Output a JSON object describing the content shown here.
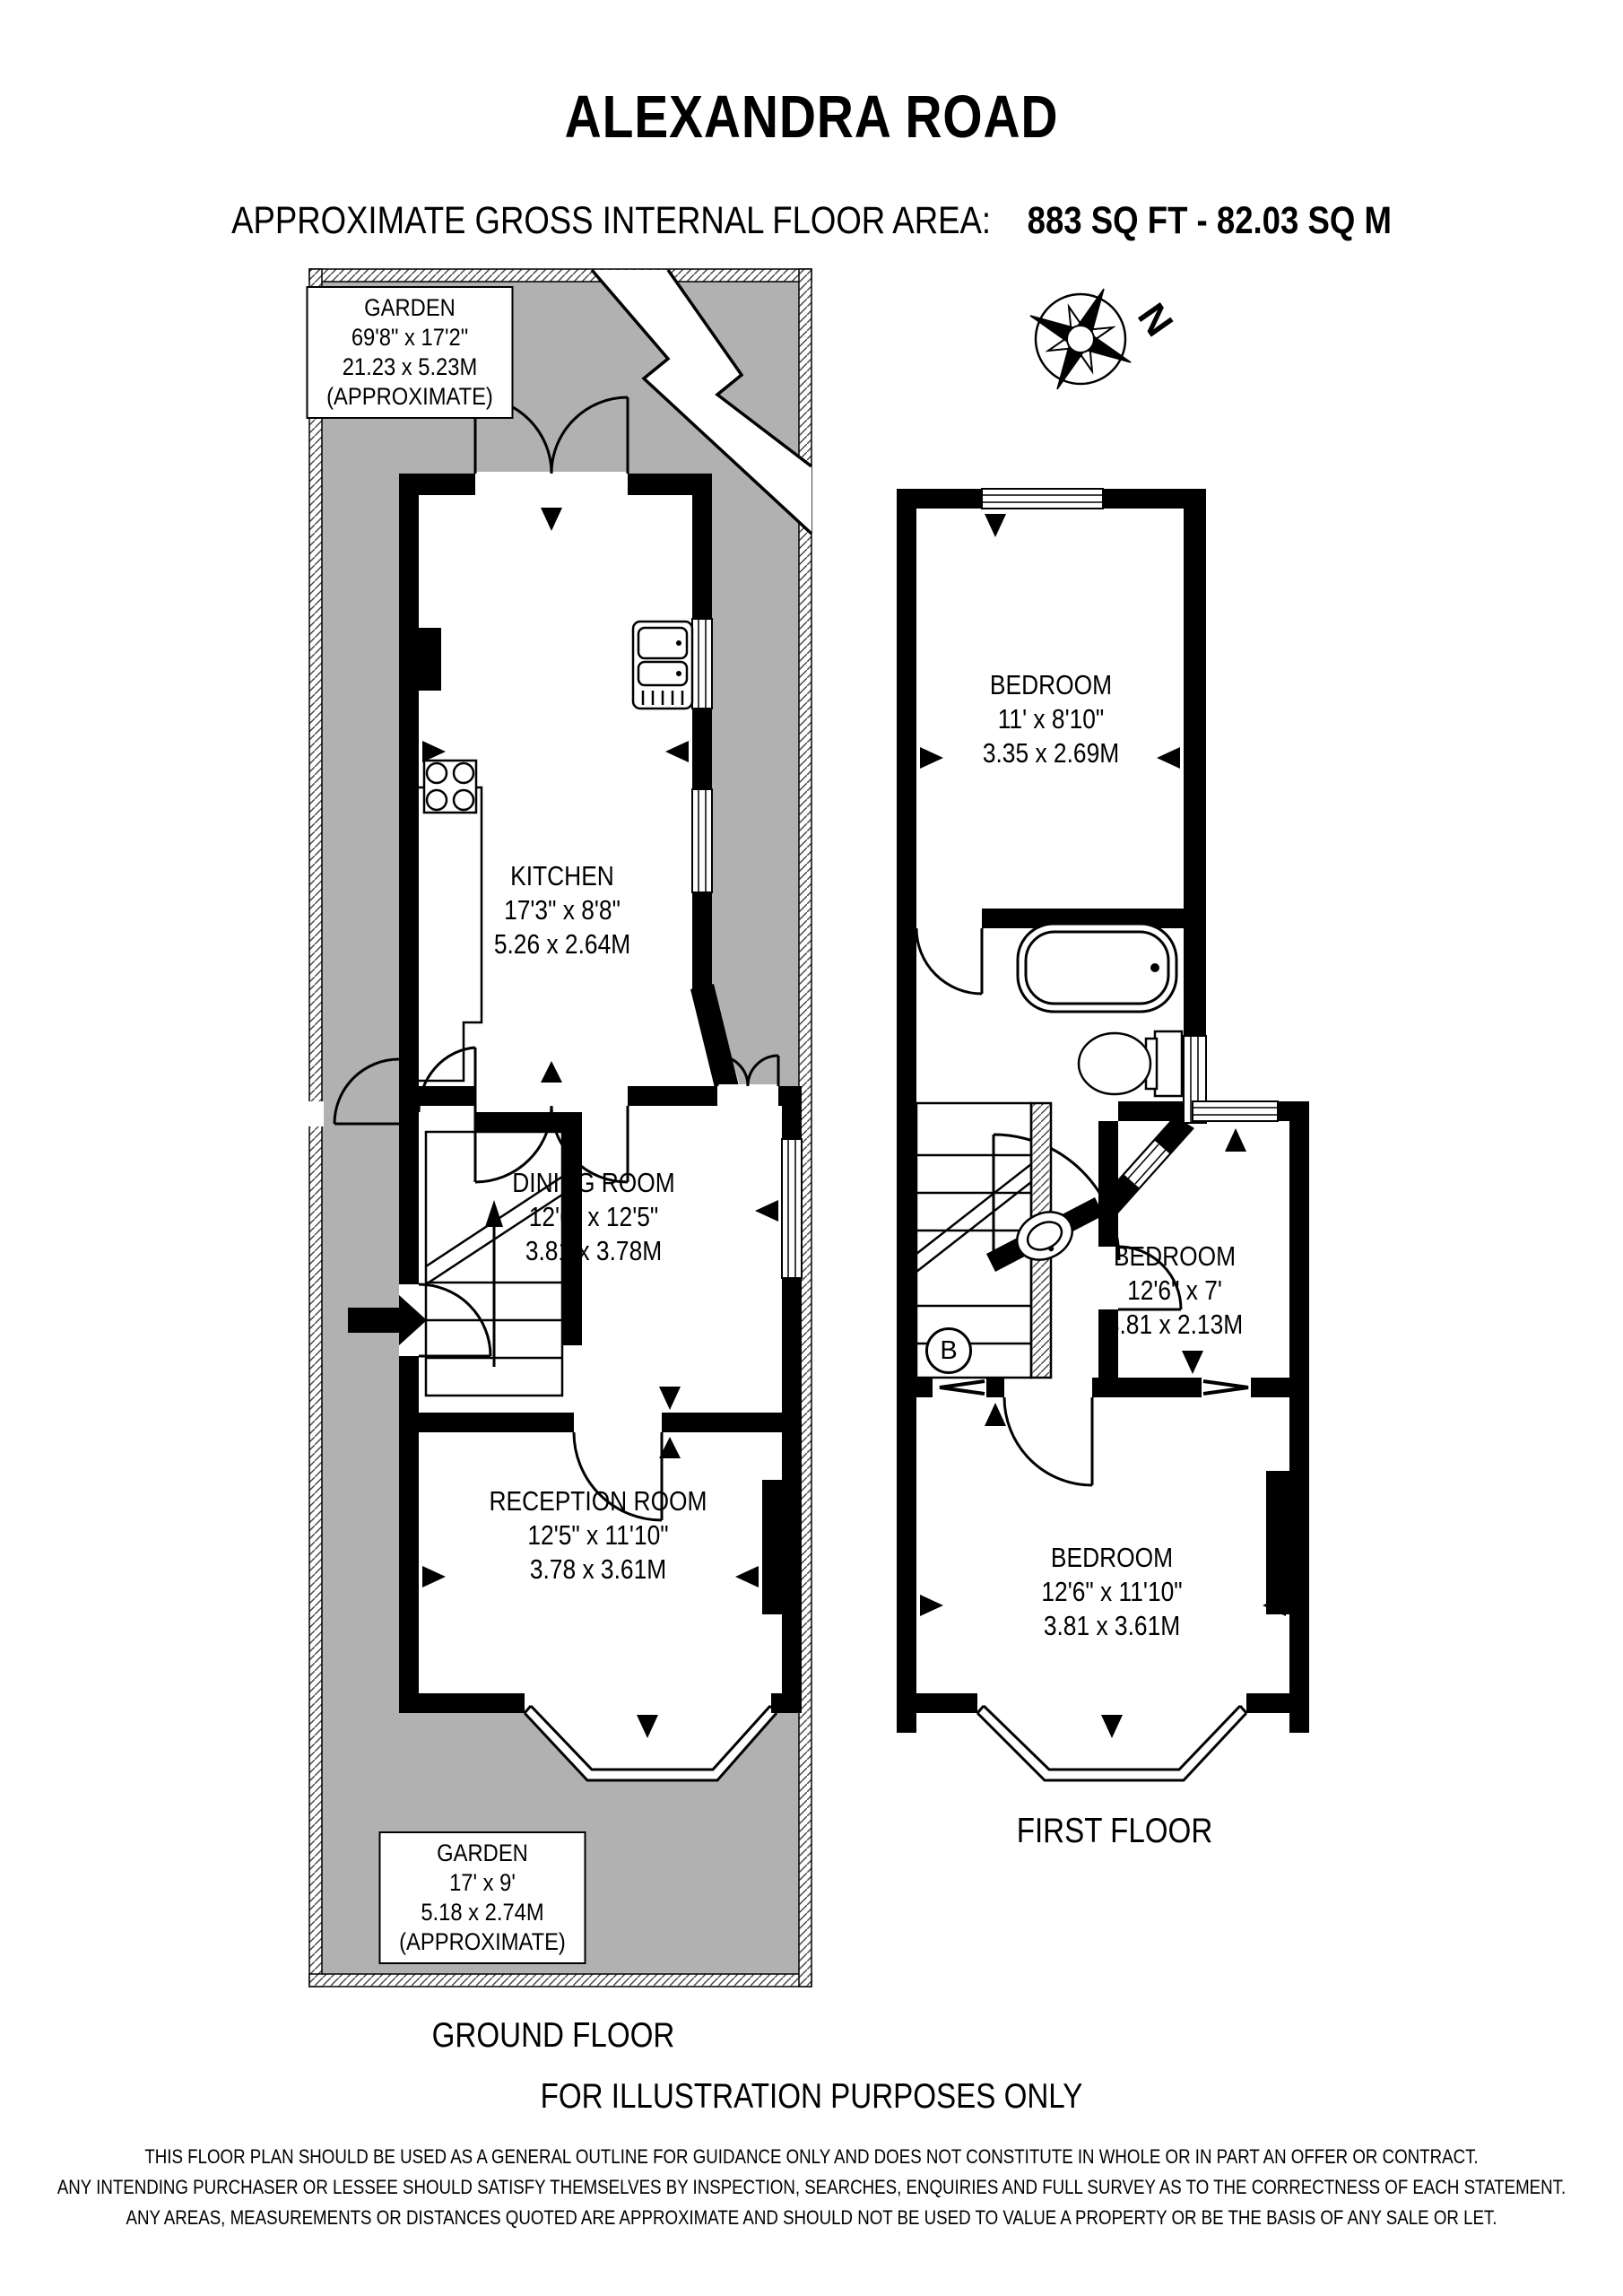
{
  "header": {
    "title": "ALEXANDRA ROAD",
    "subtitle_prefix": "APPROXIMATE GROSS INTERNAL FLOOR AREA:",
    "subtitle_value": "883 SQ FT - 82.03 SQ M"
  },
  "compass": {
    "north_label": "N"
  },
  "ground_floor": {
    "floor_label": "GROUND FLOOR",
    "garden_top": {
      "name": "GARDEN",
      "imperial": "69'8\" x 17'2\"",
      "metric": "21.23 x 5.23M",
      "note": "(APPROXIMATE)"
    },
    "garden_bottom": {
      "name": "GARDEN",
      "imperial": "17' x 9'",
      "metric": "5.18 x 2.74M",
      "note": "(APPROXIMATE)"
    },
    "kitchen": {
      "name": "KITCHEN",
      "imperial": "17'3\" x 8'8\"",
      "metric": "5.26 x 2.64M"
    },
    "dining_room": {
      "name": "DINING ROOM",
      "imperial": "12'6\" x 12'5\"",
      "metric": "3.81 x 3.78M"
    },
    "reception_room": {
      "name": "RECEPTION ROOM",
      "imperial": "12'5\" x 11'10\"",
      "metric": "3.78 x 3.61M"
    }
  },
  "first_floor": {
    "floor_label": "FIRST FLOOR",
    "bedroom_rear": {
      "name": "BEDROOM",
      "imperial": "11' x 8'10\"",
      "metric": "3.35 x 2.69M"
    },
    "bedroom_middle": {
      "name": "BEDROOM",
      "imperial": "12'6\" x 7'",
      "metric": "3.81 x 2.13M"
    },
    "bedroom_front": {
      "name": "BEDROOM",
      "imperial": "12'6\" x 11'10\"",
      "metric": "3.81 x 3.61M"
    },
    "stairs_label": "B"
  },
  "footer": {
    "illustration_note": "FOR ILLUSTRATION PURPOSES ONLY",
    "disclaimer": [
      "THIS FLOOR PLAN SHOULD BE USED AS A GENERAL OUTLINE FOR GUIDANCE ONLY AND DOES NOT CONSTITUTE IN WHOLE OR IN PART AN OFFER OR CONTRACT.",
      "ANY INTENDING PURCHASER OR LESSEE SHOULD SATISFY THEMSELVES BY INSPECTION, SEARCHES, ENQUIRIES AND FULL SURVEY AS TO THE CORRECTNESS OF EACH STATEMENT.",
      "ANY AREAS, MEASUREMENTS OR DISTANCES QUOTED ARE APPROXIMATE AND SHOULD NOT BE USED TO VALUE A PROPERTY OR BE THE BASIS OF ANY SALE OR LET."
    ]
  }
}
